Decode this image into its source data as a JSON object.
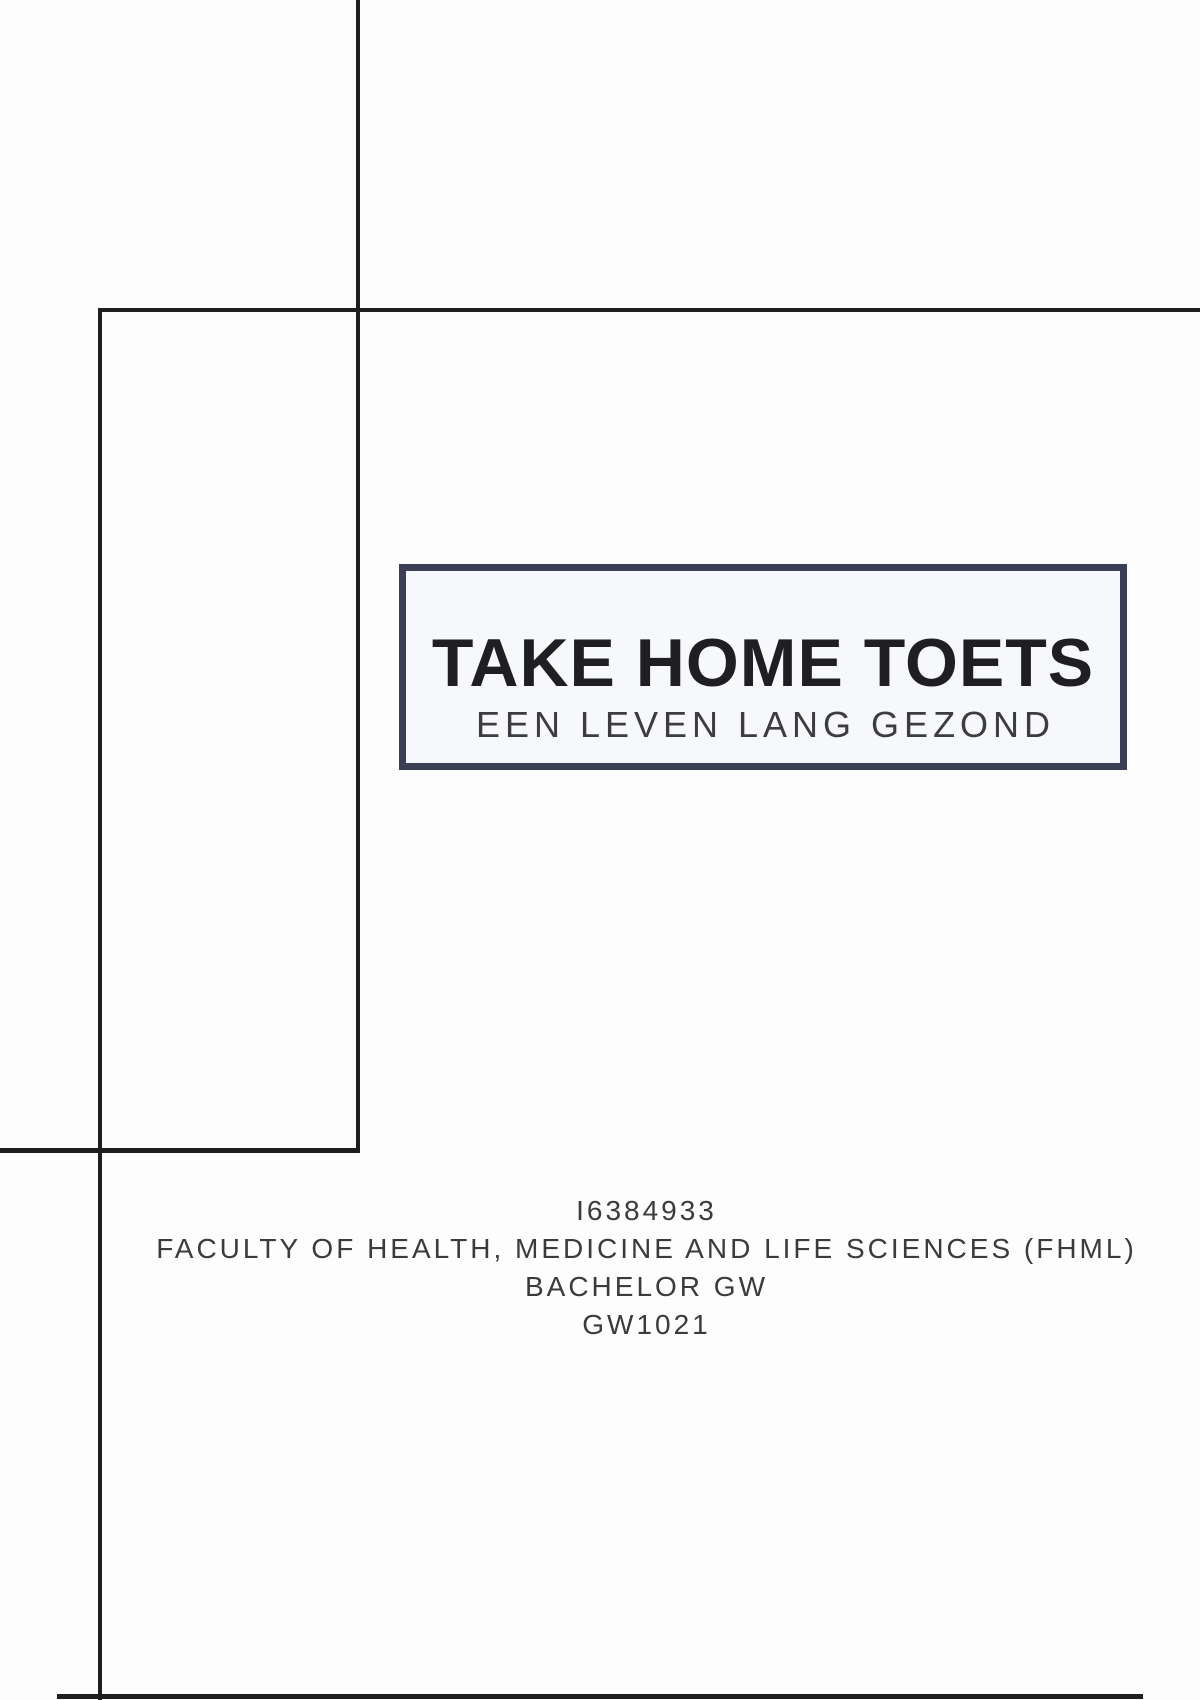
{
  "colors": {
    "rule": "#1f1f1f",
    "box_border": "#3a3f55",
    "box_fill": "#f7f8fc",
    "title_ink": "#1f1f22",
    "subtitle_ink": "#3d3d3d",
    "info_ink": "#3b3b3b",
    "page_bg": "#fdfdfd"
  },
  "title_box": {
    "title": "TAKE HOME TOETS",
    "subtitle": "EEN LEVEN LANG GEZOND"
  },
  "info_block": {
    "lines": [
      "I6384933",
      "FACULTY OF HEALTH, MEDICINE AND LIFE SCIENCES (FHML)",
      "BACHELOR GW",
      "GW1021"
    ]
  }
}
